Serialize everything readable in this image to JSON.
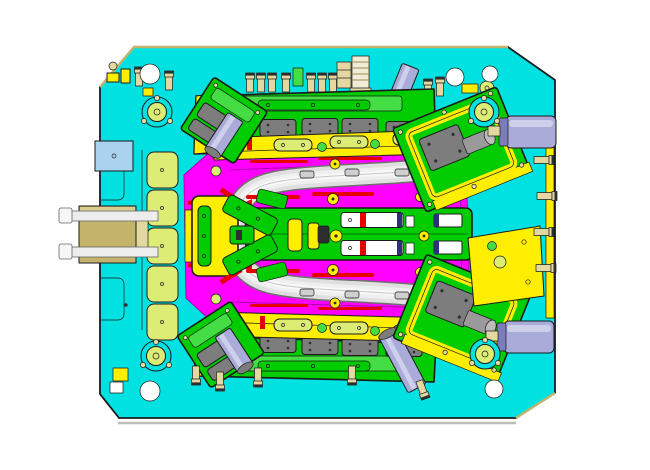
{
  "scene": {
    "type": "cad-model-top-view",
    "subject": "injection-mold-tool-assembly",
    "text_visible": false,
    "background": "#ffffff"
  },
  "colors": {
    "base": "#00e2e2",
    "outline": "#1b1b1b",
    "green": "#00cc00",
    "green2": "#44dd44",
    "greendark": "#007700",
    "pale": "#dcec74",
    "yellow": "#ffee00",
    "yellowdark": "#8f7d00",
    "magenta": "#ff00ff",
    "magentadark": "#b000b0",
    "red": "#e60000",
    "lav": "#a9abd8",
    "lavlight": "#cdcfeb",
    "lavdark": "#7b7dba",
    "gray": "#7d7d7d",
    "graydark": "#2e2e2e",
    "part": "#dfdfdf",
    "partshade": "#6f6f6f",
    "partmid": "#efefef",
    "parthi": "#f8f8f8",
    "partline": "#c8c8c8",
    "white": "#ffffff",
    "beige": "#e3d9a0",
    "beigedark": "#8a7a2a",
    "cream": "#f1ecd6",
    "tan": "#c4b36b",
    "tanlight": "#d9cd92",
    "blue": "#a9d3ef",
    "bluedark": "#30307a",
    "shadow": "#bdbdbd"
  },
  "parts": [
    {
      "id": "base-plate",
      "color_key": "base"
    },
    {
      "id": "cavity-surface",
      "color_key": "magenta"
    },
    {
      "id": "molded-part-u-panel",
      "color_key": "part"
    },
    {
      "id": "center-ejector-rail",
      "color_key": "green"
    },
    {
      "id": "lifter-spider",
      "color_key": "green"
    },
    {
      "id": "top-clamp-plate",
      "color_key": "green"
    },
    {
      "id": "bottom-clamp-plate",
      "color_key": "green"
    },
    {
      "id": "corner-slide-top-left",
      "color_key": "green"
    },
    {
      "id": "corner-slide-top-right",
      "color_key": "green"
    },
    {
      "id": "corner-slide-bottom-left",
      "color_key": "green"
    },
    {
      "id": "corner-slide-bottom-right",
      "color_key": "green"
    },
    {
      "id": "hydraulic-cylinder-right-top",
      "color_key": "lav"
    },
    {
      "id": "hydraulic-cylinder-right-bottom",
      "color_key": "lav"
    },
    {
      "id": "angle-pins",
      "color_key": "lav"
    },
    {
      "id": "guide-bushings",
      "color_key": "pale"
    },
    {
      "id": "wear-pads-left-column",
      "color_key": "pale"
    },
    {
      "id": "gray-wear-plates",
      "color_key": "gray"
    },
    {
      "id": "water-fittings",
      "color_key": "beige"
    },
    {
      "id": "latch-lock-left",
      "color_key": "tan"
    },
    {
      "id": "seal-strips",
      "color_key": "red"
    }
  ]
}
